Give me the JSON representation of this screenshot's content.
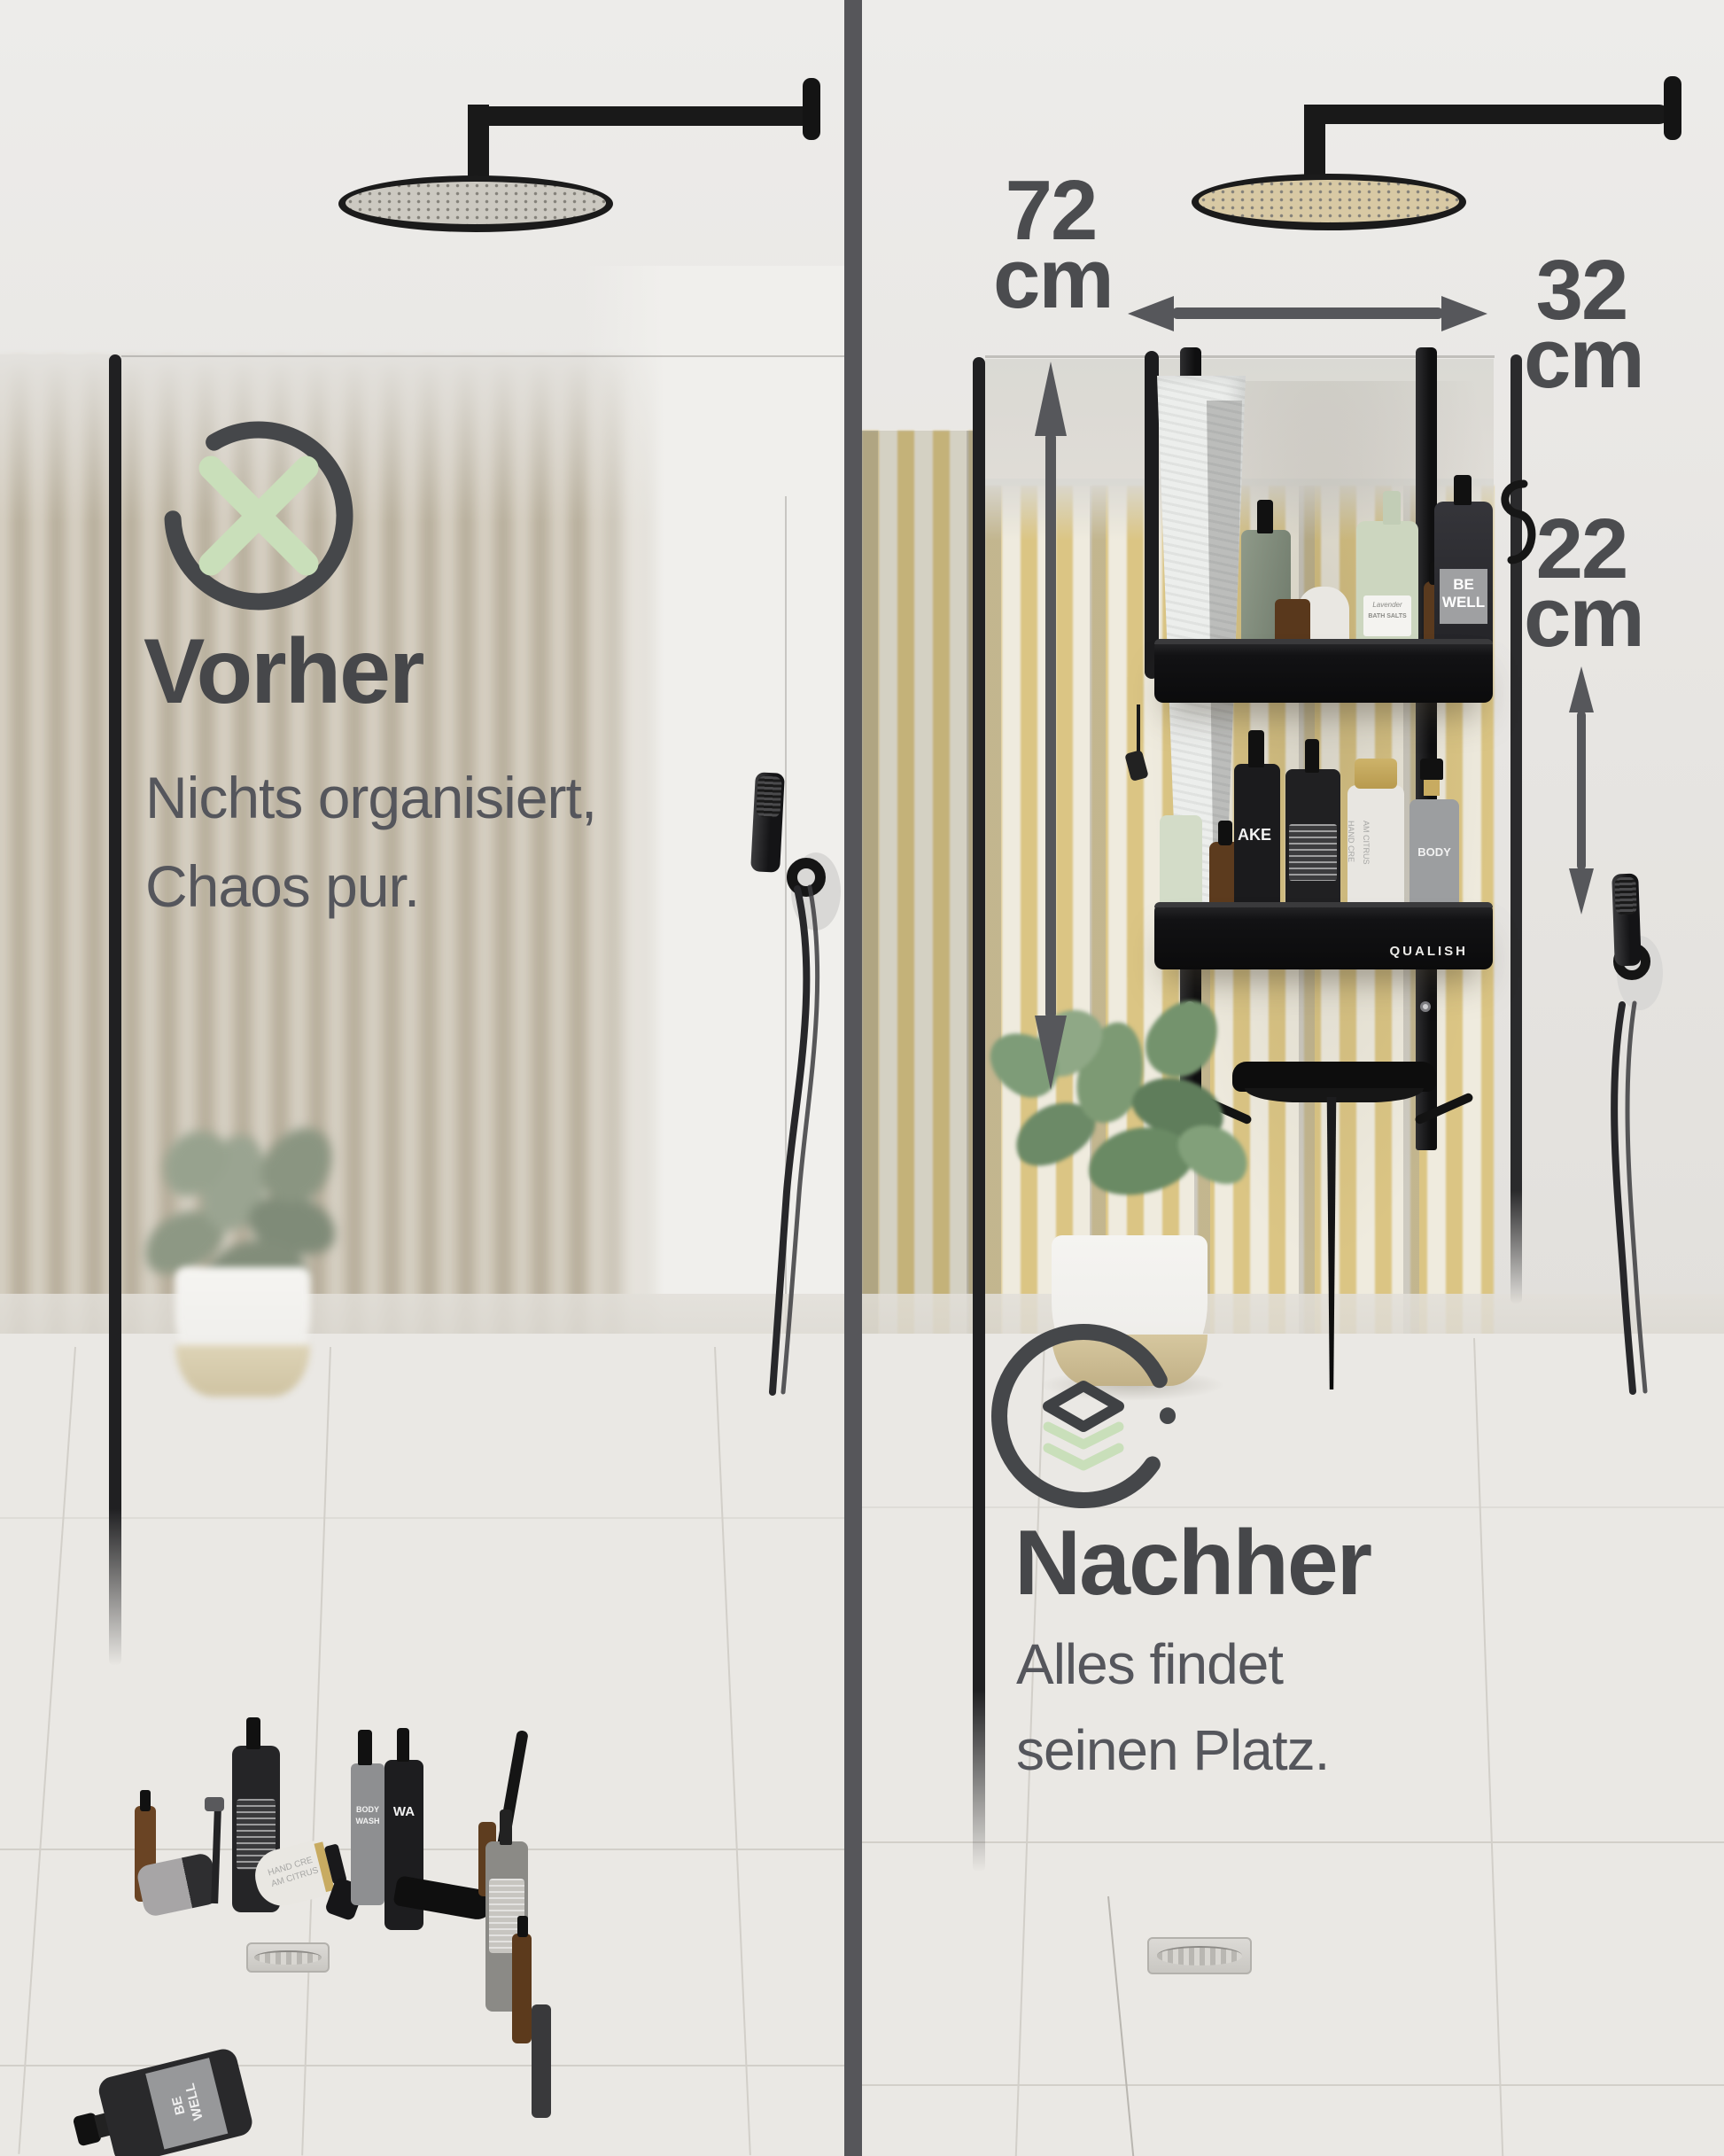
{
  "left_panel": {
    "title": "Vorher",
    "subtitle_line1": "Nichts organisiert,",
    "subtitle_line2": "Chaos pur."
  },
  "right_panel": {
    "title": "Nachher",
    "subtitle_line1": "Alles findet",
    "subtitle_line2": "seinen Platz.",
    "shelf_brand": "QUALISH",
    "measurements": {
      "height_value": "72",
      "height_unit": "cm",
      "width_value": "32",
      "width_unit": "cm",
      "gap_value": "22",
      "gap_unit": "cm"
    }
  },
  "product_labels": {
    "be_well_line1": "BE",
    "be_well_line2": "WELL",
    "bath_salts_line1": "Lavender",
    "bath_salts_line2": "BATH SALTS",
    "wake_bottle": "AKE",
    "citrus_line1": "HAND CRE",
    "citrus_line2": "AM CITRUS",
    "body_bottle": "BODY",
    "body_wash_line1": "BODY",
    "body_wash_line2": "WASH",
    "floor_pump_label": "WA"
  },
  "colors": {
    "accent_green": "#c9dfba",
    "heading_ink": "#46474a",
    "subtitle_ink": "#55565c",
    "arrow_gray": "#56575b",
    "divider_gray": "#56565a",
    "slat_yellow": "#d9bf72",
    "caddy_black": "#151515"
  }
}
